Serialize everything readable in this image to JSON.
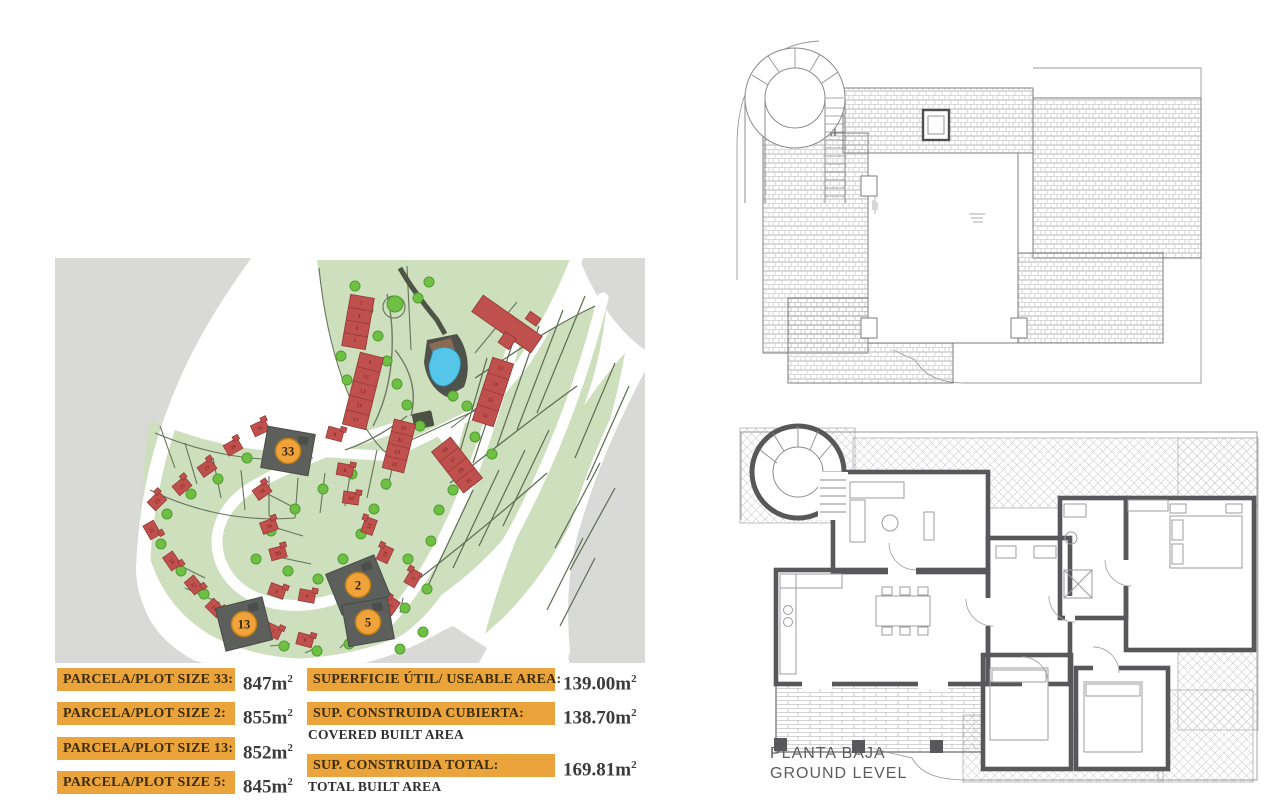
{
  "site_plan": {
    "highlighted_plots": [
      {
        "number": "33"
      },
      {
        "number": "2"
      },
      {
        "number": "13"
      },
      {
        "number": "5"
      }
    ],
    "house_numbers": [
      "1",
      "3",
      "5",
      "7",
      "9",
      "11",
      "13",
      "15",
      "17",
      "19",
      "21",
      "23",
      "25",
      "17",
      "15",
      "13",
      "11",
      "09",
      "07",
      "05",
      "01",
      "31",
      "29",
      "27",
      "25",
      "23",
      "21",
      "19",
      "17",
      "15",
      "6",
      "8",
      "10",
      "12",
      "14",
      "1",
      "3",
      "18",
      "16",
      "20",
      "6",
      "4",
      "7",
      "9"
    ],
    "colors": {
      "land": "#cddfbc",
      "outside": "#d9dad8",
      "road": "#ffffff",
      "house": "#c0504d",
      "tree": "#6fbf44",
      "pool": "#55c6e9",
      "highlight_plot": "#5d5f5c",
      "marker": "#f1a33b"
    }
  },
  "plot_size_table": {
    "rows": [
      {
        "label": "PARCELA/PLOT SIZE 33:",
        "value": "847m",
        "exponent": "2"
      },
      {
        "label": "PARCELA/PLOT SIZE 2:",
        "value": "855m",
        "exponent": "2"
      },
      {
        "label": "PARCELA/PLOT SIZE 13:",
        "value": "852m",
        "exponent": "2"
      },
      {
        "label": "PARCELA/PLOT SIZE 5:",
        "value": "845m",
        "exponent": "2"
      }
    ]
  },
  "area_table": {
    "rows": [
      {
        "label": "SUPERFICIE ÚTIL/ USEABLE AREA:",
        "sublabel": "",
        "value": "139.00m",
        "exponent": "2"
      },
      {
        "label": "SUP. CONSTRUIDA CUBIERTA:",
        "sublabel": "COVERED BUILT AREA",
        "value": "138.70m",
        "exponent": "2"
      },
      {
        "label": "SUP. CONSTRUIDA TOTAL:",
        "sublabel": "TOTAL BUILT AREA",
        "value": "169.81m",
        "exponent": "2"
      }
    ]
  },
  "ground_floor_plan": {
    "title_es": "PLANTA BAJA",
    "title_en": "GROUND LEVEL"
  }
}
